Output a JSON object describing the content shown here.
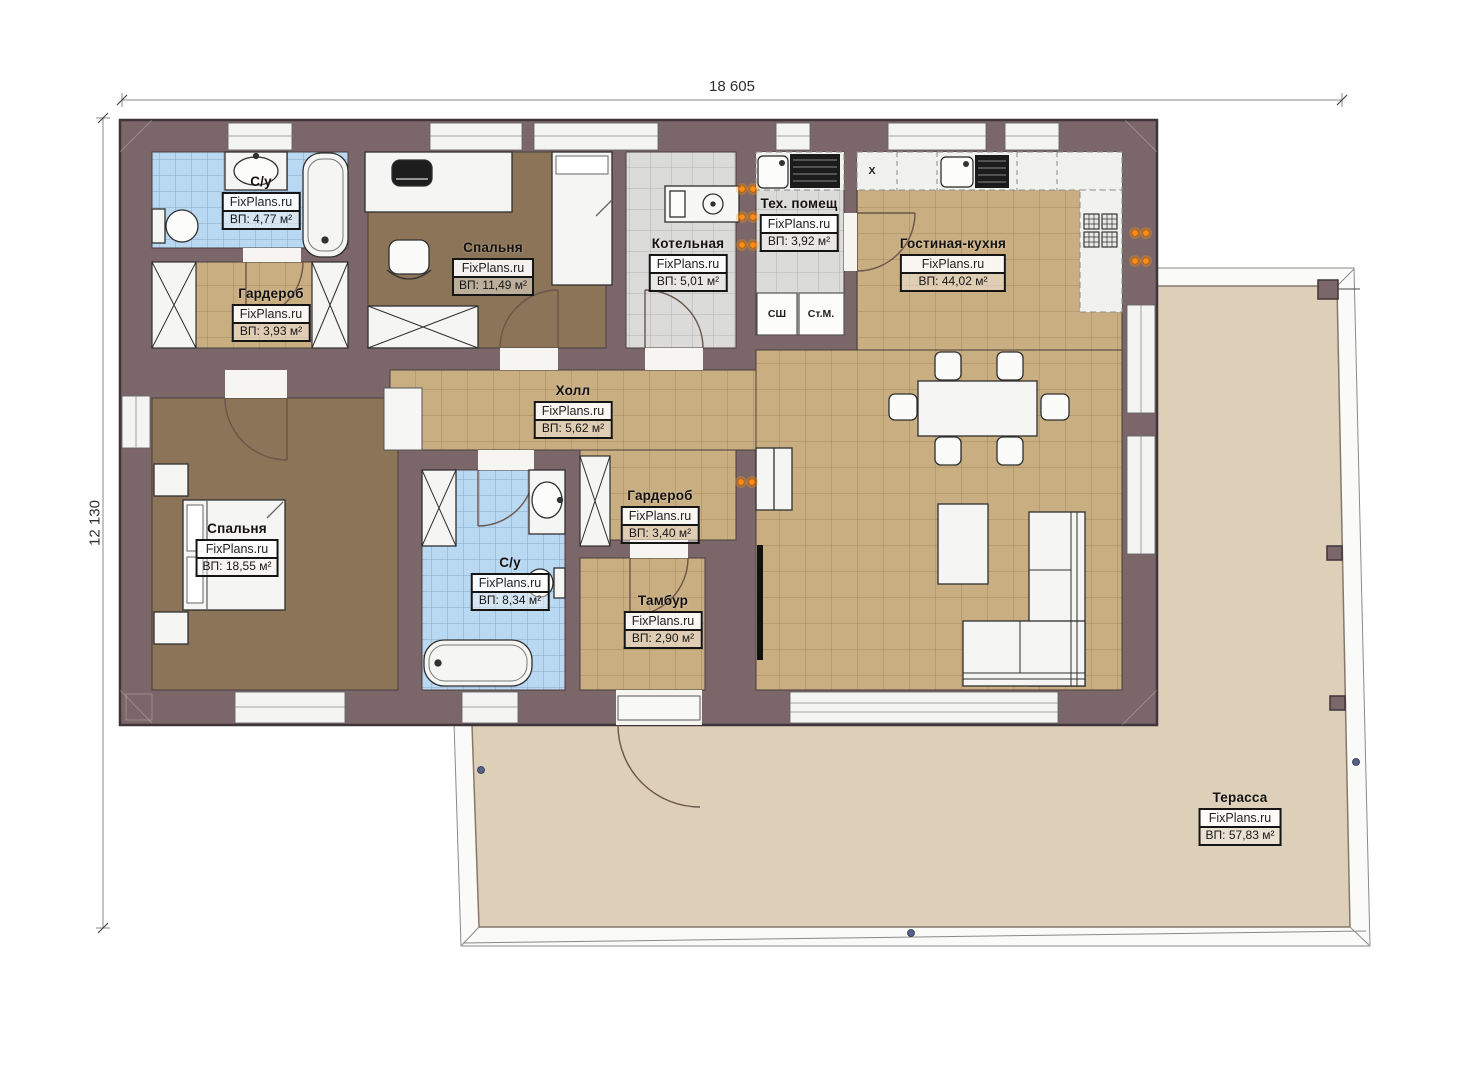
{
  "brand": "FixPlans.ru",
  "plan": {
    "width_dimension": "18 605",
    "height_dimension": "12 130"
  },
  "rooms": [
    {
      "name": "С/у",
      "area": "ВП: 4,77 м²"
    },
    {
      "name": "Гардероб",
      "area": "ВП: 3,93 м²"
    },
    {
      "name": "Спальня",
      "area": "ВП: 11,49 м²"
    },
    {
      "name": "Котельная",
      "area": "ВП: 5,01 м²"
    },
    {
      "name": "Тех. помещ",
      "area": "ВП: 3,92 м²"
    },
    {
      "name": "Гостиная-кухня",
      "area": "ВП: 44,02 м²"
    },
    {
      "name": "Холл",
      "area": "ВП: 5,62 м²"
    },
    {
      "name": "Спальня",
      "area": "ВП: 18,55 м²"
    },
    {
      "name": "С/у",
      "area": "ВП: 8,34 м²"
    },
    {
      "name": "Гардероб",
      "area": "ВП: 3,40 м²"
    },
    {
      "name": "Тамбур",
      "area": "ВП: 2,90 м²"
    },
    {
      "name": "Терасса",
      "area": "ВП: 57,83 м²"
    }
  ],
  "appliances": {
    "drying_cabinet": "СШ",
    "washing_machine": "Ст.М.",
    "kitchen_hood": "X"
  },
  "colors": {
    "wall": "#7b666a",
    "tile_tan": "#c9ae82",
    "tile_blue": "#b9d9f2",
    "tile_gray": "#dbdbda",
    "floor_wood": "#8b7457",
    "terrace": "#ddcfb8",
    "socket_orange": "#ff8c1a"
  }
}
